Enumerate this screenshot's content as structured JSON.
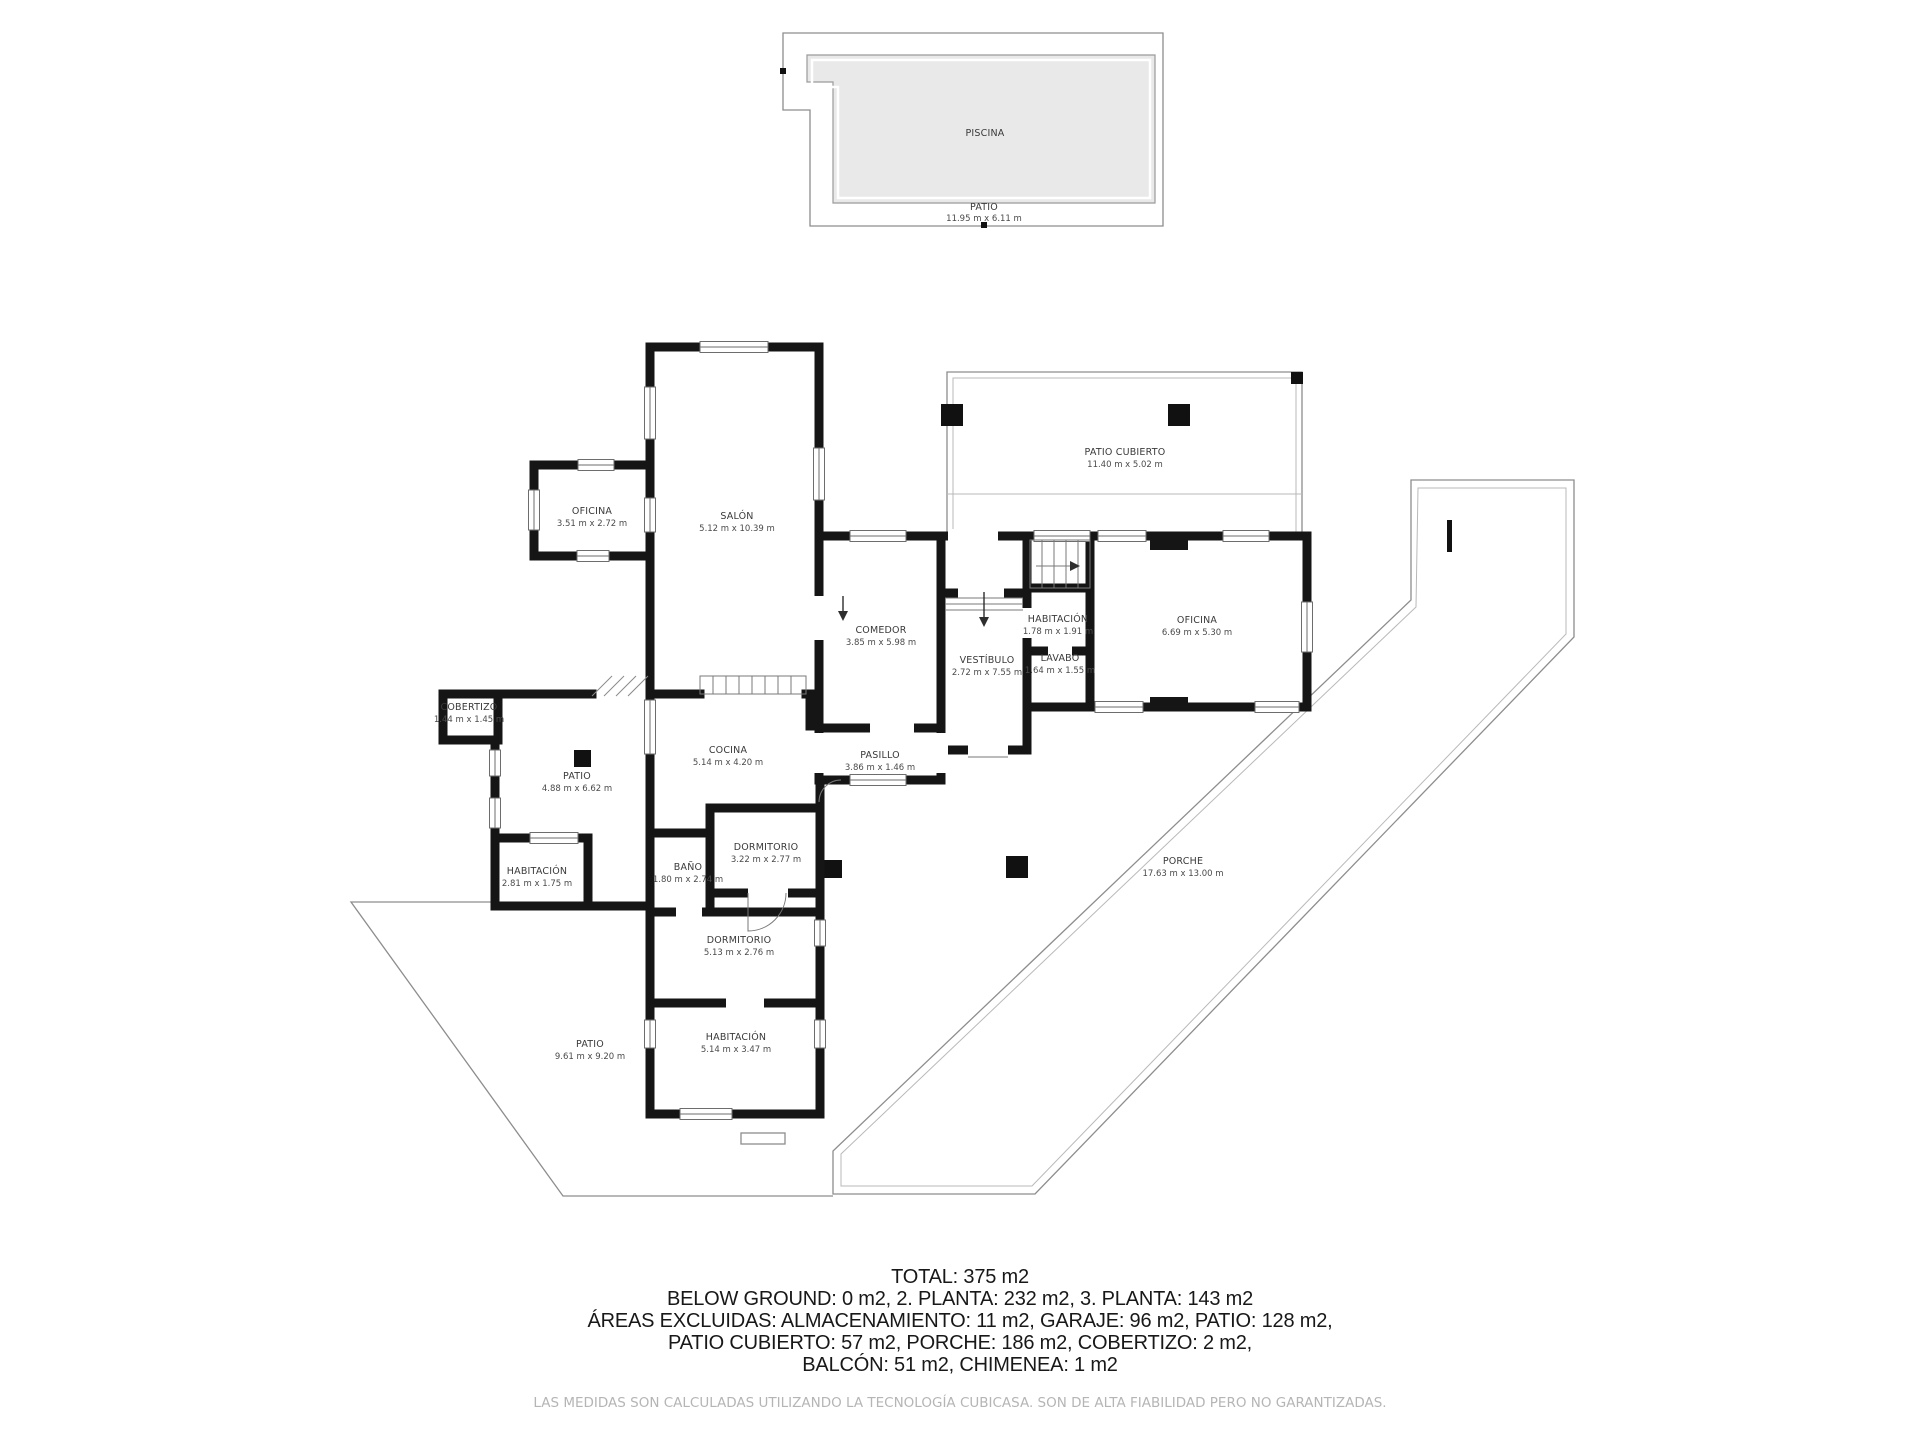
{
  "floorplan": {
    "pool": {
      "label": "PISCINA",
      "patio_label": "PATIO",
      "patio_dims": "11.95 m x 6.11 m"
    },
    "rooms": [
      {
        "id": "patio-cubierto",
        "label": "PATIO CUBIERTO",
        "dims": "11.40 m x 5.02 m"
      },
      {
        "id": "oficina-left",
        "label": "OFICINA",
        "dims": "3.51 m x 2.72 m"
      },
      {
        "id": "salon",
        "label": "SALÓN",
        "dims": "5.12 m x 10.39 m"
      },
      {
        "id": "comedor",
        "label": "COMEDOR",
        "dims": "3.85 m x 5.98 m"
      },
      {
        "id": "habitacion-right",
        "label": "HABITACIÓN",
        "dims": "1.78 m x 1.91 m"
      },
      {
        "id": "oficina-right",
        "label": "OFICINA",
        "dims": "6.69 m x 5.30 m"
      },
      {
        "id": "vestibulo",
        "label": "VESTÍBULO",
        "dims": "2.72 m x 7.55 m"
      },
      {
        "id": "lavabo",
        "label": "LAVABO",
        "dims": "1.64 m x 1.55 m"
      },
      {
        "id": "cobertizo",
        "label": "COBERTIZO",
        "dims": "1.44 m x 1.45 m"
      },
      {
        "id": "cocina",
        "label": "COCINA",
        "dims": "5.14 m x 4.20 m"
      },
      {
        "id": "pasillo",
        "label": "PASILLO",
        "dims": "3.86 m x 1.46 m"
      },
      {
        "id": "patio-upper",
        "label": "PATIO",
        "dims": "4.88 m x 6.62 m"
      },
      {
        "id": "habitacion-left",
        "label": "HABITACIÓN",
        "dims": "2.81 m x 1.75 m"
      },
      {
        "id": "bano",
        "label": "BAÑO",
        "dims": "1.80 m x 2.74 m"
      },
      {
        "id": "dormitorio-small",
        "label": "DORMITORIO",
        "dims": "3.22 m x 2.77 m"
      },
      {
        "id": "dormitorio-long",
        "label": "DORMITORIO",
        "dims": "5.13 m x 2.76 m"
      },
      {
        "id": "habitacion-bottom",
        "label": "HABITACIÓN",
        "dims": "5.14 m x 3.47 m"
      },
      {
        "id": "patio-bottom",
        "label": "PATIO",
        "dims": "9.61 m x 9.20 m"
      },
      {
        "id": "porche",
        "label": "PORCHE",
        "dims": "17.63 m x 13.00 m"
      }
    ],
    "footer": {
      "lines": [
        "TOTAL: 375 m2",
        "BELOW GROUND: 0 m2, 2. PLANTA: 232 m2, 3. PLANTA: 143 m2",
        "ÁREAS EXCLUIDAS: ALMACENAMIENTO: 11 m2, GARAJE: 96 m2, PATIO: 128 m2,",
        "PATIO CUBIERTO: 57 m2, PORCHE: 186 m2, COBERTIZO: 2 m2,",
        "BALCÓN: 51 m2, CHIMENEA: 1 m2"
      ],
      "disclaimer": "LAS MEDIDAS SON CALCULADAS UTILIZANDO LA TECNOLOGÍA CUBICASA. SON DE ALTA FIABILIDAD PERO NO GARANTIZADAS."
    },
    "colors": {
      "wall": "#151515",
      "outline": "#8d8d8d",
      "pool_fill": "#e9e9e9",
      "footer_text": "#181818",
      "disclaimer_text": "#b5b5b5"
    }
  }
}
